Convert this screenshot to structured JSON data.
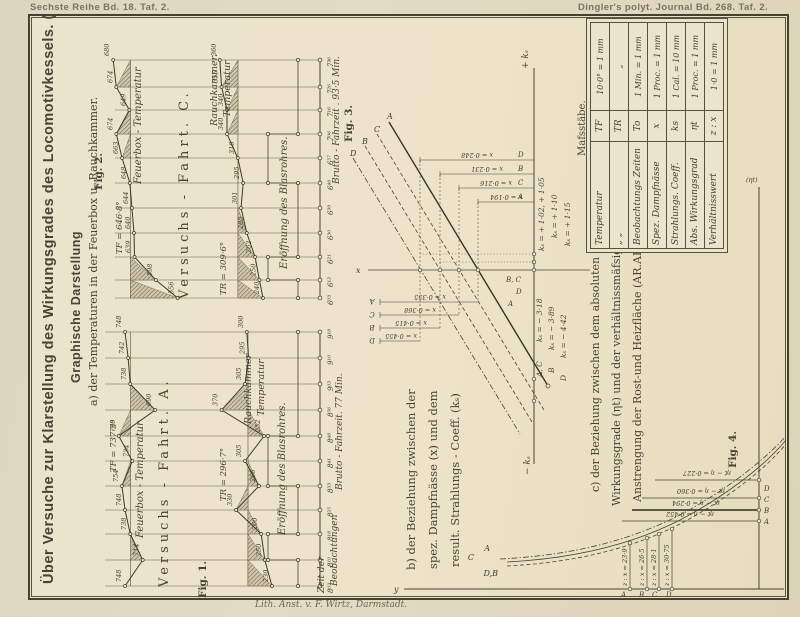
{
  "page": {
    "header_left": "Sechste Reihe Bd. 18. Taf. 2.",
    "header_right": "Dingler's polyt. Journal Bd. 268. Taf. 2.",
    "footer": "Lith. Anst. v. F. Wirtz, Darmstadt.",
    "title": "Über Versuche zur Klarstellung des Wirkungsgrades des Locomotivkessels. (Taf. 1 u. 2.)",
    "subtitle": "Graphische Darstellung",
    "section_a": "a) der Temperaturen in der Feuerbox u. Rauchkammer.",
    "section_b": [
      "b) der Beziehung zwischen der",
      "spez. Dampfnässe (x) und dem",
      "result. Strahlungs - Coeff. (kₛ)"
    ],
    "section_c": [
      "c) der Beziehung zwischen dem absoluten",
      "Wirkungsgrade (ηt) und der verhältnissmäfsigen",
      "Anstrengung der Rost-und Heizfläche (AR.AF)"
    ]
  },
  "scales": {
    "title": "Mafsstäbe.",
    "rows": [
      {
        "name": "Temperatur",
        "symbol": "TF",
        "scale": "10·0° = 1 mm"
      },
      {
        "name": "„          „",
        "symbol": "TR",
        "scale": "„"
      },
      {
        "name": "Beobachtungs Zeiten",
        "symbol": "To",
        "scale": "1 Min. = 1 mm"
      },
      {
        "name": "Spez. Dampfnässe",
        "symbol": "x",
        "scale": "1 Proc. = 1 mm"
      },
      {
        "name": "Strahlungs. Coeff.",
        "symbol": "ks",
        "scale": "1 Cal. = 10 mm"
      },
      {
        "name": "Abs. Wirkungsgrad",
        "symbol": "ηt",
        "scale": "1 Proc. = 1 mm"
      },
      {
        "name": "Verhältnisswert",
        "symbol": "z : x",
        "scale": "1·0 = 1 mm"
      }
    ]
  },
  "chart_data": [
    {
      "id": "fig1",
      "type": "line",
      "label": "Fig. 1.",
      "train": "Versuchs - Fahrt. A.",
      "x_axis_label_1": "Zeit der",
      "x_axis_label_2": "Beobachtungen",
      "duration": "Brutto - Fahrzeit. 77 Min.",
      "times": [
        "9¹⁸",
        "9¹⁰",
        "9⁰³",
        "8⁵⁶",
        "8⁴⁸",
        "8⁴¹",
        "8³³",
        "8²⁵",
        "8¹⁸",
        "8¹⁰",
        "8⁰³"
      ],
      "series": [
        {
          "name": "Feuerbox - Temperatur",
          "mean_label": "TF = 737·3°",
          "mean_value": 737.3,
          "values": [
            748,
            742,
            738,
            690,
            760,
            734,
            754,
            748,
            738,
            714,
            748
          ]
        },
        {
          "name_l1": "Rauchkammer -",
          "name_l2": "Temperatur",
          "mean_label": "TR = 296·7°",
          "mean_value": 296.7,
          "values": [
            300,
            295,
            305,
            370,
            252,
            305,
            266,
            330,
            260,
            250,
            230
          ]
        }
      ],
      "step_series": "Eröffnung des Blasrohres."
    },
    {
      "id": "fig2",
      "type": "line",
      "label": "Fig. 2.",
      "train": "Versuchs - Fahrt. C.",
      "duration": "Brutto - Fahrzeit . 93·5 Min.",
      "times": [
        "7³⁶",
        "7²⁶",
        "7¹⁶",
        "7⁰⁶",
        "6⁵⁷",
        "6⁴⁸",
        "6³⁹",
        "6³⁰",
        "6²¹",
        "6¹²",
        "6⁰³"
      ],
      "series": [
        {
          "name": "Feuerbox - Temperatur",
          "mean_label": "TF = 646·8°",
          "mean_value": 646.8,
          "values": [
            680,
            674,
            649,
            674,
            663,
            648,
            644,
            640,
            639,
            598,
            556
          ]
        },
        {
          "name_l1": "Rauchkammer.",
          "name_l2": "Temperatur",
          "mean_label": "TR = 309·6°",
          "mean_value": 309.6,
          "values": [
            360,
            355,
            340,
            340,
            310,
            295,
            301,
            285,
            262,
            250,
            240
          ]
        }
      ],
      "step_series": "Eröffnung des Blasrohres."
    },
    {
      "id": "fig3",
      "type": "diagram",
      "label": "Fig. 3.",
      "axes": {
        "pos": "+ kₛ",
        "neg": "− kₛ",
        "x": "x"
      },
      "lines": [
        "D",
        "B",
        "C",
        "A"
      ],
      "top_dims": [
        {
          "run": "D",
          "label": "x = 0·248"
        },
        {
          "run": "B",
          "label": "x = 0·231"
        },
        {
          "run": "C",
          "label": "x = 0·216"
        },
        {
          "run": "A",
          "label": "x = 0·194"
        }
      ],
      "ks_pos": [
        "kₛ = + 1·02, + 1·05",
        "kₛ = + 1·10",
        "kₛ = + 1·15"
      ],
      "mid_runs": [
        "B, C",
        "D",
        "A"
      ],
      "bottom_dims": [
        {
          "run": "A",
          "label": "x = 0·355"
        },
        {
          "run": "C",
          "label": "x = 0·368"
        },
        {
          "run": "B",
          "label": "x = 0·415"
        },
        {
          "run": "D",
          "label": "x = 0·455"
        }
      ],
      "ks_neg": [
        {
          "run": "A, C",
          "label": "kₛ = − 3·18"
        },
        {
          "run": "B",
          "label": "kₛ = − 3·89"
        },
        {
          "run": "D",
          "label": "kₛ = − 4·42"
        }
      ]
    },
    {
      "id": "fig4",
      "type": "line",
      "label": "Fig. 4.",
      "y_label": "y",
      "right_axis": "(ηt)",
      "curve_labels": [
        "C",
        "A",
        "D,B"
      ],
      "points": [
        {
          "run": "A",
          "zx": "z : x = 23·9"
        },
        {
          "run": "B",
          "zx": "z : x = 26·5"
        },
        {
          "run": "C",
          "zx": "z : x = 28·1"
        },
        {
          "run": "D",
          "zx": "z : x = 30·75"
        }
      ],
      "eta_lines": [
        "ηt − η = 0·227",
        "ηt − η = 0·360",
        "ηt − η = 0·294",
        "ηt − η = 0·452"
      ],
      "right_letters": [
        "A",
        "B",
        "C",
        "D"
      ]
    }
  ]
}
